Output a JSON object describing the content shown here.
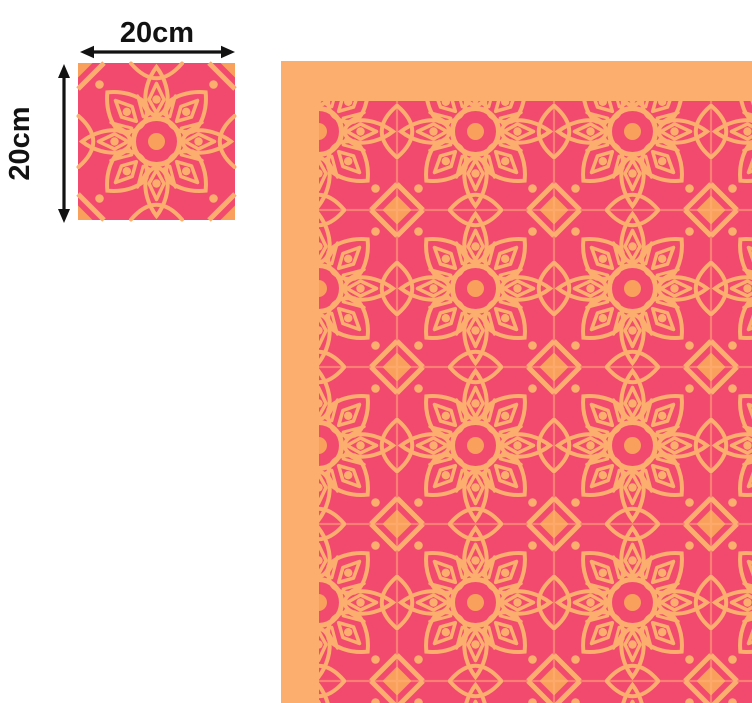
{
  "colors": {
    "tile_pink": "#f24a6e",
    "pattern_orange": "#fbae6e",
    "pattern_orange_deep": "#f9a05c",
    "grout_line": "#ffb27a",
    "dimension_black": "#121212",
    "page_background": "#ffffff"
  },
  "tile_sample": {
    "width_label": "20cm",
    "height_label": "20cm"
  }
}
